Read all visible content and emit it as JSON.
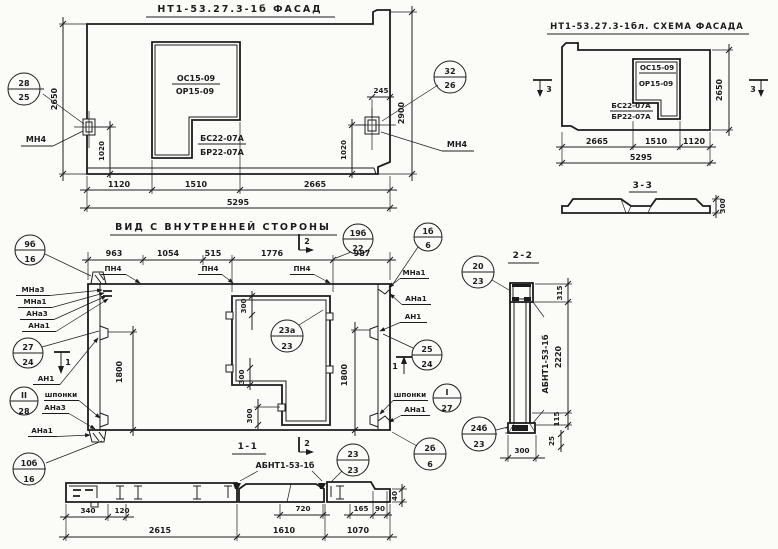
{
  "facade": {
    "title": "НТ1-53.27.3-1б  ФАСАД",
    "window": {
      "top1": "ОС15-09",
      "top2": "ОР15-09",
      "bot1": "БС22-07А",
      "bot2": "БР22-07А"
    },
    "anchor_label": "МН4",
    "callout_left": {
      "top": "28",
      "bottom": "25"
    },
    "callout_right": {
      "top": "32",
      "bottom": "26"
    },
    "dim_height_left": "2650",
    "dim_height_right": "2900",
    "dim_offset": "245",
    "dim_anchor": "1020",
    "dims_bottom": [
      "1120",
      "1510",
      "2665"
    ],
    "dim_total": "5295"
  },
  "scheme": {
    "title": "НТ1-53.27.3-1бл. СХЕМА ФАСАДА",
    "window": {
      "top1": "ОС15-09",
      "top2": "ОР15-09",
      "bot1": "БС22-07А",
      "bot2": "БР22-07А"
    },
    "section_mark": "3",
    "dim_height": "2650",
    "dims_bottom": [
      "2665",
      "1510",
      "1120"
    ],
    "dim_total": "5295",
    "section": {
      "title": "3-3",
      "dim_thickness": "300"
    }
  },
  "inner": {
    "title": "ВИД С ВНУТРЕННЕЙ СТОРОНЫ",
    "dims_top": [
      "963",
      "1054",
      "515",
      "1776",
      "987"
    ],
    "pn4": "ПН4",
    "left_labels": [
      "МНа3",
      "МНа1",
      "АНа3",
      "АНа1"
    ],
    "an1": "АН1",
    "shponki": "шпонки",
    "dim_1800": "1800",
    "dim_300": "300",
    "mark1": "1",
    "mark2": "2",
    "callouts": {
      "c9b16": {
        "top": "9б",
        "bottom": "16"
      },
      "c27_24": {
        "top": "27",
        "bottom": "24"
      },
      "cII_28": {
        "top": "II",
        "bottom": "28"
      },
      "c10b16": {
        "top": "10б",
        "bottom": "16"
      },
      "c19b22": {
        "top": "19б",
        "bottom": "22"
      },
      "c1b6": {
        "top": "1б",
        "bottom": "6"
      },
      "c25_24": {
        "top": "25",
        "bottom": "24"
      },
      "cI_27": {
        "top": "I",
        "bottom": "27"
      },
      "c23a23": {
        "top": "23а",
        "bottom": "23"
      },
      "c2b6": {
        "top": "2б",
        "bottom": "6"
      }
    }
  },
  "s22": {
    "title": "2-2",
    "label": "АБНТ1-53-1б",
    "callout_top": {
      "top": "20",
      "bottom": "23"
    },
    "callout_bottom": {
      "top": "24б",
      "bottom": "23"
    },
    "dim_315": "315",
    "dim_2220": "2220",
    "dim_115": "115",
    "dim_25": "25",
    "dim_300": "300"
  },
  "s11": {
    "title": "1-1",
    "label": "АБНТ1-53-1б",
    "callout": {
      "top": "23",
      "bottom": "23"
    },
    "dims_top": [
      "340",
      "120",
      "720",
      "165",
      "90"
    ],
    "dims_bottom": [
      "2615",
      "1610",
      "1070"
    ],
    "dim_40": "40"
  }
}
